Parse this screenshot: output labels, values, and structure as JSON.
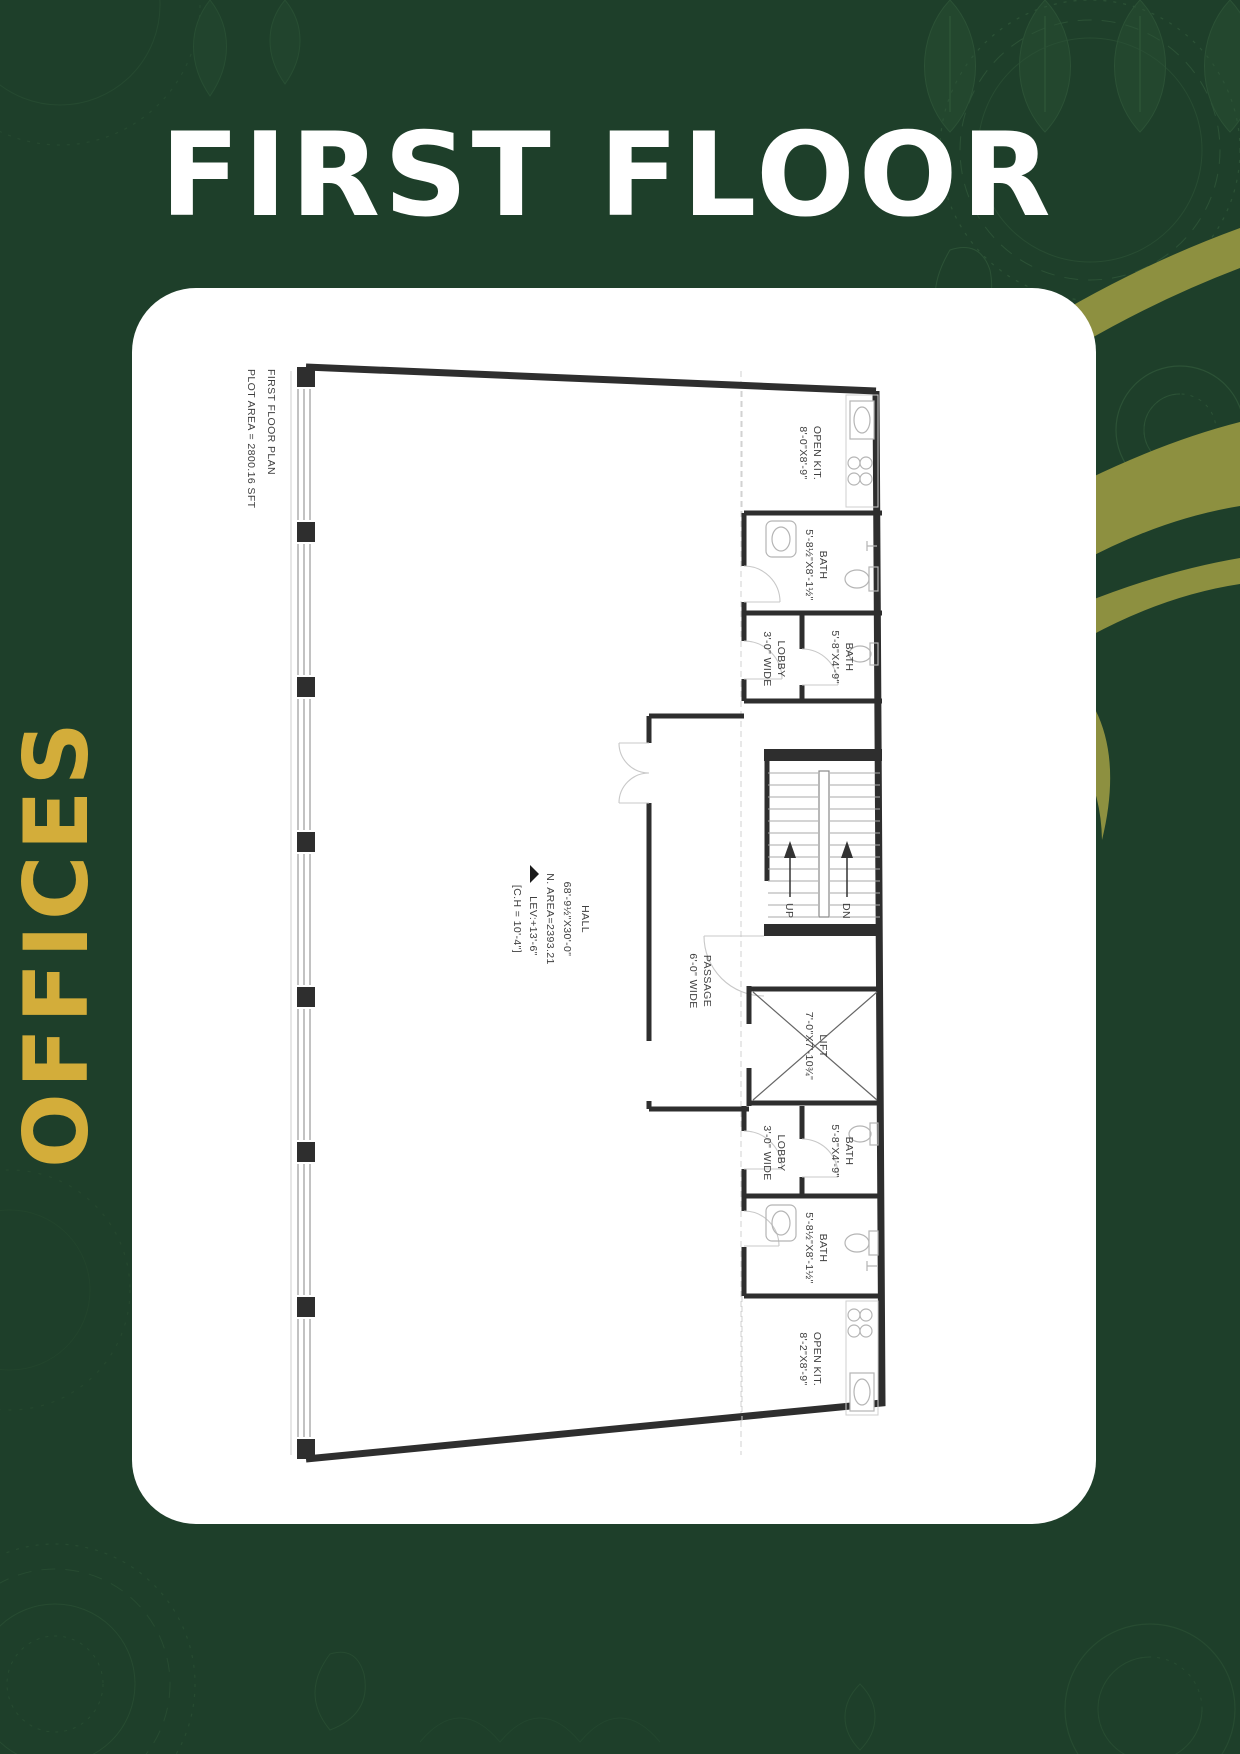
{
  "colors": {
    "background": "#1e3f2a",
    "card": "#ffffff",
    "title": "#ffffff",
    "gold": "#d3ad3a",
    "swoosh_olive": "#8d9040",
    "wall": "#2e2e2e",
    "plan_text": "#3f3f3f",
    "net_area_red": "#bf4e4e"
  },
  "header": {
    "title": "FIRST FLOOR"
  },
  "side_label": {
    "text": "OFFICES"
  },
  "plan": {
    "title": "FIRST FLOOR PLAN",
    "plot_area": "PLOT AREA = 2800.16 SFT",
    "hall": {
      "name": "HALL",
      "dims": "68'-9½\"X30'-0\"",
      "net_area": "N. AREA=2393.21",
      "level": "LEV:+13'-6\"",
      "ceiling": "[C.H = 10'-4\"]"
    },
    "passage": {
      "name": "PASSAGE",
      "dims": "6'-0\" WIDE"
    },
    "open_kitchen_top": {
      "name": "OPEN KIT.",
      "dims": "8'-0\"X8'-9\""
    },
    "open_kitchen_bottom": {
      "name": "OPEN KIT.",
      "dims": "8'-2\"X8'-9\""
    },
    "bath_large": {
      "name": "BATH",
      "dims": "5'-8½\"X8'-1½\""
    },
    "bath_small": {
      "name": "BATH",
      "dims": "5'-8\"X4'-9\""
    },
    "lobby": {
      "name": "LOBBY",
      "dims": "3'-0\" WIDE"
    },
    "lift": {
      "name": "LIFT",
      "dims": "7'-0\"X7'-10¾\""
    },
    "stairs": {
      "up": "UP",
      "down": "DN"
    }
  }
}
